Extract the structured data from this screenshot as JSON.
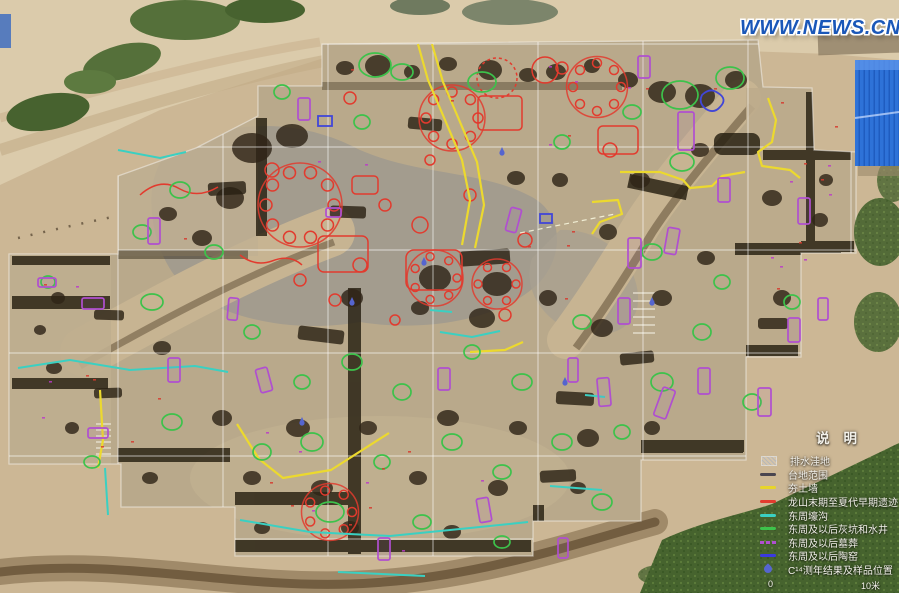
{
  "watermark": {
    "text": "WWW.NEWS.CN",
    "color": "#1a57b8"
  },
  "legend": {
    "title": "说明",
    "items": [
      {
        "label": "排水洼地",
        "swatch": "hatch",
        "color": "#b8b8b8"
      },
      {
        "label": "台地范围",
        "swatch": "line",
        "color": "#4a4650"
      },
      {
        "label": "夯土墙",
        "swatch": "line",
        "color": "#e8d52a"
      },
      {
        "label": "龙山末期至夏代早期遗迹",
        "swatch": "line",
        "color": "#e23b2e"
      },
      {
        "label": "东周壕沟",
        "swatch": "line",
        "color": "#3ad0c2"
      },
      {
        "label": "东周及以后灰坑和水井",
        "swatch": "line",
        "color": "#3dc24b"
      },
      {
        "label": "东周及以后墓葬",
        "swatch": "dash",
        "color": "#b04fd0"
      },
      {
        "label": "东周及以后陶窑",
        "swatch": "line",
        "color": "#3a3ae0"
      },
      {
        "label": "C¹⁴测年结果及样品位置",
        "swatch": "drop",
        "color": "#5565cf"
      }
    ],
    "scale": {
      "start": "0",
      "end": "10米"
    }
  }
}
